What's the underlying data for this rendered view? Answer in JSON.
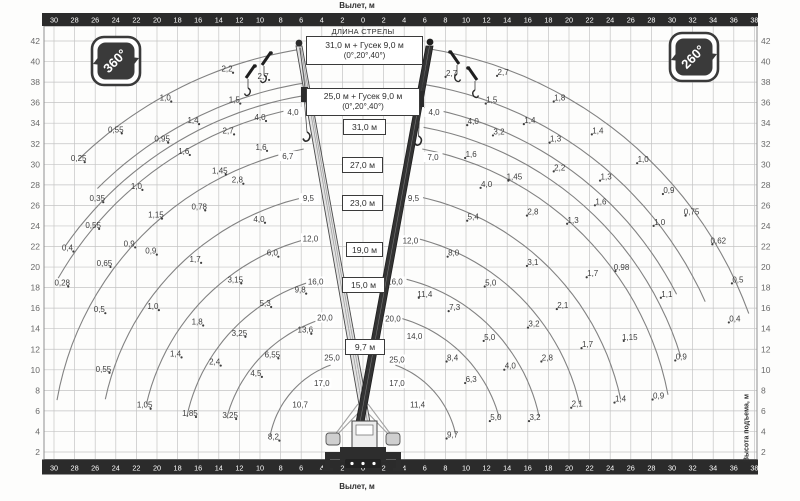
{
  "titles": {
    "x_axis_top": "Вылет, м",
    "x_axis_bottom": "Вылет, м",
    "y_axis_right": "Высота подъема, м",
    "boom_length_header": "ДЛИНА СТРЕЛЫ"
  },
  "badges": {
    "left": "360°",
    "right": "260°"
  },
  "config_boxes": [
    {
      "line1": "31,0 м + Гусек 9,0 м",
      "line2": "(0°,20°,40°)"
    },
    {
      "line1": "25,0 м + Гусек 9,0 м",
      "line2": "(0°,20°,40°)"
    }
  ],
  "boom_boxes": [
    "31,0 м",
    "27,0 м",
    "23,0 м",
    "19,0 м",
    "15,0 м",
    "9,7 м"
  ],
  "chart_data": {
    "type": "line",
    "title": "Грузовысотные характеристики",
    "xlabel": "Вылет, м",
    "ylabel": "Высота подъема, м",
    "x_range_m": [
      -30,
      38
    ],
    "y_range_m": [
      0,
      43
    ],
    "grid": true,
    "x_ticks": [
      -30,
      -28,
      -26,
      -24,
      -22,
      -20,
      -18,
      -16,
      -14,
      -12,
      -10,
      -8,
      -6,
      -4,
      -2,
      0,
      2,
      4,
      6,
      8,
      10,
      12,
      14,
      16,
      18,
      20,
      22,
      24,
      26,
      28,
      30,
      32,
      34,
      36,
      38
    ],
    "y_ticks": [
      2,
      4,
      6,
      8,
      10,
      12,
      14,
      16,
      18,
      20,
      22,
      24,
      26,
      28,
      30,
      32,
      34,
      36,
      38,
      40,
      42
    ],
    "slew_zones": {
      "left": "360°",
      "right": "260°"
    },
    "boom_configs": [
      "31,0 м + Гусек 9,0 м (0°,20°,40°)",
      "25,0 м + Гусек 9,0 м (0°,20°,40°)",
      "31,0 м",
      "27,0 м",
      "23,0 м",
      "19,0 м",
      "15,0 м",
      "9,7 м"
    ],
    "pivot": {
      "x_m": 0,
      "h_m": 1.8
    },
    "arcs": {
      "left": [
        {
          "R": 9.2,
          "a1": 70,
          "a2": 11
        },
        {
          "R": 13.7,
          "a1": 74,
          "a2": 15
        },
        {
          "R": 17.5,
          "a1": 76,
          "a2": 12
        },
        {
          "R": 21.6,
          "a1": 77,
          "a2": 13
        },
        {
          "R": 25.6,
          "a1": 78,
          "a2": 12
        },
        {
          "R": 30.2,
          "a1": 79,
          "a2": 10
        },
        {
          "R": 34.2,
          "a1": 80,
          "a2": 30
        },
        {
          "R": 35.3,
          "a1": 80.5,
          "a2": 35
        },
        {
          "R": 36.5,
          "a1": 81,
          "a2": 45
        },
        {
          "R": 39.8,
          "a1": 81.5,
          "a2": 46
        }
      ],
      "right": [
        {
          "R": 9.2,
          "a1": 70,
          "a2": 12
        },
        {
          "R": 13.7,
          "a1": 74,
          "a2": 15
        },
        {
          "R": 17.5,
          "a1": 76,
          "a2": 12
        },
        {
          "R": 21.6,
          "a1": 77,
          "a2": 13
        },
        {
          "R": 25.6,
          "a1": 78,
          "a2": 12
        },
        {
          "R": 30.2,
          "a1": 79,
          "a2": 11
        },
        {
          "R": 32.3,
          "a1": 79.5,
          "a2": 17
        },
        {
          "R": 34.2,
          "a1": 80,
          "a2": 27
        },
        {
          "R": 36.4,
          "a1": 80.5,
          "a2": 24
        },
        {
          "R": 39.9,
          "a1": 81,
          "a2": 20
        }
      ]
    },
    "capacity_labels_t": {
      "left": [
        {
          "v": "2,7",
          "r": 9.7,
          "h": 38.6
        },
        {
          "v": "2,2",
          "r": 13.2,
          "h": 39.3
        },
        {
          "v": "1,0",
          "r": 19.2,
          "h": 36.5
        },
        {
          "v": "0,55",
          "r": 24.0,
          "h": 33.4
        },
        {
          "v": "0,25",
          "r": 27.6,
          "h": 30.6
        },
        {
          "v": "1,5",
          "r": 12.5,
          "h": 36.3
        },
        {
          "v": "1,4",
          "r": 16.5,
          "h": 34.3
        },
        {
          "v": "0,95",
          "r": 19.5,
          "h": 32.5
        },
        {
          "v": "0,35",
          "r": 25.8,
          "h": 26.7
        },
        {
          "v": "4,0",
          "r": 6.8,
          "h": 35.1,
          "c": true
        },
        {
          "v": "4,0",
          "r": 10.0,
          "h": 34.6
        },
        {
          "v": "2,7",
          "r": 13.1,
          "h": 33.3
        },
        {
          "v": "1,6",
          "r": 17.4,
          "h": 31.3
        },
        {
          "v": "1,0",
          "r": 22.0,
          "h": 27.9
        },
        {
          "v": "0,55",
          "r": 26.2,
          "h": 24.1
        },
        {
          "v": "0,4",
          "r": 28.7,
          "h": 21.9
        },
        {
          "v": "0,28",
          "r": 29.2,
          "h": 18.5
        },
        {
          "v": "6,7",
          "r": 7.3,
          "h": 30.8,
          "c": true
        },
        {
          "v": "1,6",
          "r": 9.9,
          "h": 31.7
        },
        {
          "v": "1,45",
          "r": 13.9,
          "h": 29.4
        },
        {
          "v": "2,8",
          "r": 12.2,
          "h": 28.5
        },
        {
          "v": "1,15",
          "r": 20.1,
          "h": 25.1
        },
        {
          "v": "0,9",
          "r": 22.7,
          "h": 22.3
        },
        {
          "v": "0,65",
          "r": 25.1,
          "h": 20.4
        },
        {
          "v": "0,5",
          "r": 25.6,
          "h": 15.9
        },
        {
          "v": "0,78",
          "r": 15.9,
          "h": 25.9
        },
        {
          "v": "9,5",
          "r": 5.3,
          "h": 26.7,
          "c": true
        },
        {
          "v": "4,0",
          "r": 10.1,
          "h": 24.7
        },
        {
          "v": "0,9",
          "r": 20.6,
          "h": 21.6
        },
        {
          "v": "0,55",
          "r": 25.2,
          "h": 10.1
        },
        {
          "v": "12,0",
          "r": 5.1,
          "h": 22.8,
          "c": true
        },
        {
          "v": "6,0",
          "r": 8.8,
          "h": 21.4
        },
        {
          "v": "1,7",
          "r": 16.3,
          "h": 20.8
        },
        {
          "v": "1,0",
          "r": 20.4,
          "h": 16.2
        },
        {
          "v": "1,05",
          "r": 21.2,
          "h": 6.6
        },
        {
          "v": "16,0",
          "r": 4.6,
          "h": 18.6,
          "c": true
        },
        {
          "v": "9,8",
          "r": 6.1,
          "h": 17.8
        },
        {
          "v": "3,15",
          "r": 12.4,
          "h": 18.8
        },
        {
          "v": "1,8",
          "r": 16.1,
          "h": 14.7
        },
        {
          "v": "1,4",
          "r": 18.2,
          "h": 11.6
        },
        {
          "v": "1,85",
          "r": 16.8,
          "h": 5.8
        },
        {
          "v": "20,0",
          "r": 3.7,
          "h": 15.1,
          "c": true
        },
        {
          "v": "13,6",
          "r": 5.6,
          "h": 13.9
        },
        {
          "v": "5,3",
          "r": 9.5,
          "h": 16.5
        },
        {
          "v": "3,25",
          "r": 12.0,
          "h": 13.6
        },
        {
          "v": "2,4",
          "r": 14.4,
          "h": 10.8
        },
        {
          "v": "3,25",
          "r": 12.9,
          "h": 5.6
        },
        {
          "v": "25,0",
          "r": 3.0,
          "h": 11.2,
          "c": true
        },
        {
          "v": "6,55",
          "r": 8.8,
          "h": 11.5
        },
        {
          "v": "4,5",
          "r": 10.4,
          "h": 9.7
        },
        {
          "v": "17,0",
          "r": 4.0,
          "h": 8.7,
          "c": true
        },
        {
          "v": "10,7",
          "r": 6.1,
          "h": 6.6,
          "c": true
        },
        {
          "v": "8,2",
          "r": 8.7,
          "h": 3.5
        }
      ],
      "right": [
        {
          "v": "2,7",
          "r": 8.6,
          "h": 38.9
        },
        {
          "v": "2,7",
          "r": 13.6,
          "h": 39.0
        },
        {
          "v": "1,8",
          "r": 19.1,
          "h": 36.5
        },
        {
          "v": "1,5",
          "r": 12.5,
          "h": 36.3
        },
        {
          "v": "4,0",
          "r": 6.9,
          "h": 35.1,
          "c": true
        },
        {
          "v": "4,0",
          "r": 10.7,
          "h": 34.2
        },
        {
          "v": "1,4",
          "r": 16.2,
          "h": 34.3
        },
        {
          "v": "3,2",
          "r": 13.2,
          "h": 33.2
        },
        {
          "v": "1,4",
          "r": 22.8,
          "h": 33.3
        },
        {
          "v": "1,3",
          "r": 18.7,
          "h": 32.5
        },
        {
          "v": "7,0",
          "r": 6.8,
          "h": 30.7,
          "c": true
        },
        {
          "v": "1,6",
          "r": 10.5,
          "h": 31.0
        },
        {
          "v": "1,0",
          "r": 27.2,
          "h": 30.5
        },
        {
          "v": "2,2",
          "r": 19.1,
          "h": 29.7
        },
        {
          "v": "1,45",
          "r": 14.7,
          "h": 28.8
        },
        {
          "v": "1,3",
          "r": 23.6,
          "h": 28.8
        },
        {
          "v": "4,0",
          "r": 12.0,
          "h": 28.1
        },
        {
          "v": "0,9",
          "r": 29.7,
          "h": 27.5
        },
        {
          "v": "1,6",
          "r": 23.1,
          "h": 26.4
        },
        {
          "v": "0,75",
          "r": 31.9,
          "h": 25.4
        },
        {
          "v": "9,5",
          "r": 4.9,
          "h": 26.7,
          "c": true
        },
        {
          "v": "5,4",
          "r": 10.7,
          "h": 24.9
        },
        {
          "v": "2,8",
          "r": 16.5,
          "h": 25.4
        },
        {
          "v": "1,3",
          "r": 20.4,
          "h": 24.6
        },
        {
          "v": "1,0",
          "r": 28.8,
          "h": 24.4
        },
        {
          "v": "12,0",
          "r": 4.6,
          "h": 22.6,
          "c": true
        },
        {
          "v": "8,0",
          "r": 8.8,
          "h": 21.4
        },
        {
          "v": "3,1",
          "r": 16.5,
          "h": 20.5
        },
        {
          "v": "1,7",
          "r": 22.3,
          "h": 19.4
        },
        {
          "v": "0,98",
          "r": 25.1,
          "h": 20.0
        },
        {
          "v": "0,62",
          "r": 34.5,
          "h": 22.6
        },
        {
          "v": "16,0",
          "r": 3.1,
          "h": 18.6,
          "c": true
        },
        {
          "v": "11,4",
          "r": 6.0,
          "h": 17.4
        },
        {
          "v": "5,0",
          "r": 12.4,
          "h": 18.5
        },
        {
          "v": "2,1",
          "r": 19.4,
          "h": 16.3
        },
        {
          "v": "1,1",
          "r": 29.5,
          "h": 17.4
        },
        {
          "v": "0,5",
          "r": 36.4,
          "h": 18.8
        },
        {
          "v": "20,0",
          "r": 2.9,
          "h": 15.0,
          "c": true
        },
        {
          "v": "7,3",
          "r": 8.9,
          "h": 16.1
        },
        {
          "v": "3,2",
          "r": 16.6,
          "h": 14.5
        },
        {
          "v": "5,0",
          "r": 12.3,
          "h": 13.2
        },
        {
          "v": "1,7",
          "r": 21.8,
          "h": 12.5
        },
        {
          "v": "1,15",
          "r": 25.9,
          "h": 13.2
        },
        {
          "v": "0,4",
          "r": 36.1,
          "h": 15.0
        },
        {
          "v": "25,0",
          "r": 3.3,
          "h": 11.0,
          "c": true
        },
        {
          "v": "14,0",
          "r": 5.0,
          "h": 13.3,
          "c": true
        },
        {
          "v": "8,4",
          "r": 8.7,
          "h": 11.2
        },
        {
          "v": "2,8",
          "r": 17.9,
          "h": 11.2
        },
        {
          "v": "4,0",
          "r": 14.3,
          "h": 10.4
        },
        {
          "v": "0,9",
          "r": 30.9,
          "h": 11.3
        },
        {
          "v": "17,0",
          "r": 3.3,
          "h": 8.7,
          "c": true
        },
        {
          "v": "6,3",
          "r": 10.5,
          "h": 9.1
        },
        {
          "v": "11,4",
          "r": 5.3,
          "h": 6.6,
          "c": true
        },
        {
          "v": "2,1",
          "r": 20.8,
          "h": 6.7
        },
        {
          "v": "1,4",
          "r": 25.0,
          "h": 7.2
        },
        {
          "v": "0,9",
          "r": 28.7,
          "h": 7.5
        },
        {
          "v": "9,7",
          "r": 8.7,
          "h": 3.7
        },
        {
          "v": "5,0",
          "r": 12.9,
          "h": 5.4
        },
        {
          "v": "3,2",
          "r": 16.7,
          "h": 5.4
        }
      ]
    }
  }
}
